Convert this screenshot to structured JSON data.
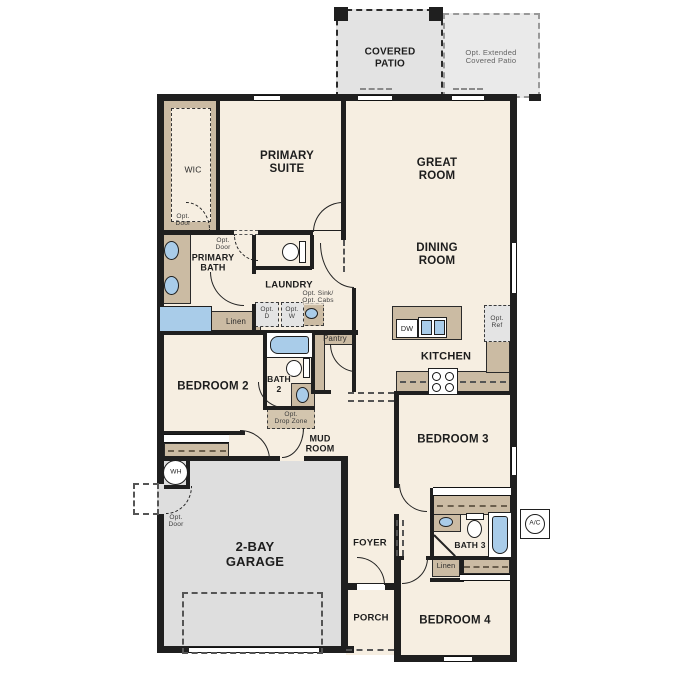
{
  "plan_title": "single-story floor plan",
  "labels": {
    "covered_patio": "COVERED\nPATIO",
    "opt_extended_patio": "Opt. Extended\nCovered Patio",
    "primary_suite": "PRIMARY\nSUITE",
    "great_room": "GREAT\nROOM",
    "dining_room": "DINING\nROOM",
    "wic": "WIC",
    "opt_door_wic": "Opt.\nDoor",
    "opt_door_bath": "Opt.\nDoor",
    "primary_bath": "PRIMARY\nBATH",
    "laundry": "LAUNDRY",
    "opt_dryer": "Opt.\nD",
    "opt_washer": "Opt.\nW",
    "opt_sink_cabs": "Opt. Sink/\nOpt. Cabs",
    "linen_primary": "Linen",
    "pantry": "Pantry",
    "kitchen": "KITCHEN",
    "opt_ref": "Opt.\nRef",
    "dishwasher": "DW",
    "bedroom_2": "BEDROOM 2",
    "bath_2": "BATH\n2",
    "opt_drop_zone": "Opt.\nDrop Zone",
    "mud_room": "MUD\nROOM",
    "bedroom_3": "BEDROOM 3",
    "water_heater": "WH",
    "opt_door_garage": "Opt.\nDoor",
    "garage": "2-BAY\nGARAGE",
    "foyer": "FOYER",
    "bath_3": "BATH 3",
    "linen_bath3": "Linen",
    "ac_unit": "A/C",
    "porch": "PORCH",
    "bedroom_4": "BEDROOM 4"
  },
  "colors": {
    "wall": "#1f1f1f",
    "floor": "#f6eee1",
    "garage_floor": "#dedede",
    "patio_floor": "#e3e3e3",
    "cabinet_tan": "#cbbba3",
    "fixture_blue": "#a9cce9",
    "optional_dash": "#555555",
    "background": "#ffffff"
  }
}
